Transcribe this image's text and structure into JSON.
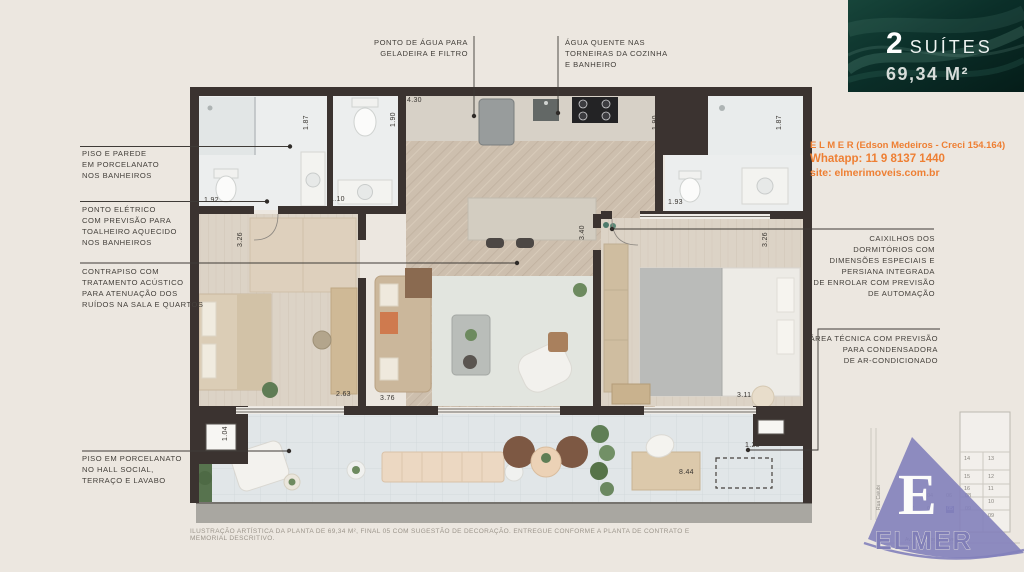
{
  "hero": {
    "suites_count": "2",
    "suites_label": "SUÍTES",
    "area": "69,34 M²"
  },
  "contact": {
    "broker": "E L M E R (Edson Medeiros - Creci 154.164)",
    "whatsapp": "Whatapp: 11 9 8137 1440",
    "site": "site: elmerimoveis.com.br"
  },
  "callouts": {
    "left": [
      {
        "lines": [
          "PISO E PAREDE",
          "EM PORCELANATO",
          "NOS BANHEIROS"
        ]
      },
      {
        "lines": [
          "PONTO ELÉTRICO",
          "COM PREVISÃO PARA",
          "TOALHEIRO AQUECIDO",
          "NOS BANHEIROS"
        ]
      },
      {
        "lines": [
          "CONTRAPISO COM",
          "TRATAMENTO ACÚSTICO",
          "PARA ATENUAÇÃO DOS",
          "RUÍDOS NA SALA E QUARTOS"
        ]
      },
      {
        "lines": [
          "PISO EM PORCELANATO",
          "NO HALL SOCIAL,",
          "TERRAÇO E LAVABO"
        ]
      }
    ],
    "top": [
      {
        "lines": [
          "PONTO DE ÁGUA PARA",
          "GELADEIRA E FILTRO"
        ]
      },
      {
        "lines": [
          "ÁGUA QUENTE NAS",
          "TORNEIRAS DA COZINHA",
          "E BANHEIRO"
        ]
      }
    ],
    "right": [
      {
        "lines": [
          "CAIXILHOS DOS",
          "DORMITÓRIOS COM",
          "DIMENSÕES ESPECIAIS E",
          "PERSIANA INTEGRADA",
          "DE ENROLAR COM PREVISÃO",
          "DE AUTOMAÇÃO"
        ]
      },
      {
        "lines": [
          "ÁREA TÉCNICA COM PREVISÃO",
          "PARA CONDENSADORA",
          "DE AR-CONDICIONADO"
        ]
      }
    ]
  },
  "dimensions": [
    {
      "value": "1.87",
      "x": 303,
      "y": 130,
      "vertical": true
    },
    {
      "value": "1.90",
      "x": 390,
      "y": 127,
      "vertical": true
    },
    {
      "value": "4.30",
      "x": 407,
      "y": 97,
      "vertical": false
    },
    {
      "value": "1.90",
      "x": 652,
      "y": 130,
      "vertical": true
    },
    {
      "value": "1.87",
      "x": 776,
      "y": 130,
      "vertical": true
    },
    {
      "value": "1.92",
      "x": 204,
      "y": 197,
      "vertical": false
    },
    {
      "value": "1.10",
      "x": 330,
      "y": 196,
      "vertical": false
    },
    {
      "value": "1.93",
      "x": 668,
      "y": 199,
      "vertical": false
    },
    {
      "value": "3.26",
      "x": 237,
      "y": 247,
      "vertical": true
    },
    {
      "value": "3.40",
      "x": 579,
      "y": 240,
      "vertical": true
    },
    {
      "value": "3.26",
      "x": 762,
      "y": 247,
      "vertical": true
    },
    {
      "value": "2.63",
      "x": 336,
      "y": 391,
      "vertical": false
    },
    {
      "value": "3.76",
      "x": 380,
      "y": 395,
      "vertical": false
    },
    {
      "value": "3.11",
      "x": 737,
      "y": 392,
      "vertical": false
    },
    {
      "value": "1.04",
      "x": 222,
      "y": 441,
      "vertical": true
    },
    {
      "value": "8.44",
      "x": 679,
      "y": 469,
      "vertical": false
    },
    {
      "value": "1.25",
      "x": 745,
      "y": 442,
      "vertical": false
    }
  ],
  "disclaimer": "ILUSTRAÇÃO ARTÍSTICA DA PLANTA DE 69,34 M², FINAL 05 COM SUGESTÃO DE DECORAÇÃO. ENTREGUE CONFORME A PLANTA DE CONTRATO E MEMORIAL DESCRITIVO.",
  "logo": {
    "initial": "E",
    "brand": "ELMER"
  },
  "keyplan": {
    "stack_rows": [
      [
        "14",
        "13"
      ],
      [
        "15",
        "12"
      ],
      [
        "16",
        "11"
      ],
      [
        "",
        "10"
      ],
      [
        "",
        "09"
      ]
    ],
    "floor_rows": [
      [
        "01",
        "04",
        "06",
        "08"
      ],
      [
        "07",
        "03",
        "05",
        "09"
      ]
    ],
    "highlighted_unit": "05",
    "street_vertical": "Rua Caiubi",
    "street_horizontal": "Av. Prof. Alfonso Bovero"
  },
  "colors": {
    "accent_orange": "#ee7f33",
    "hero_teal": "#0b2f29",
    "logo_purple": "#8381bb",
    "wall": "#3b3330"
  }
}
